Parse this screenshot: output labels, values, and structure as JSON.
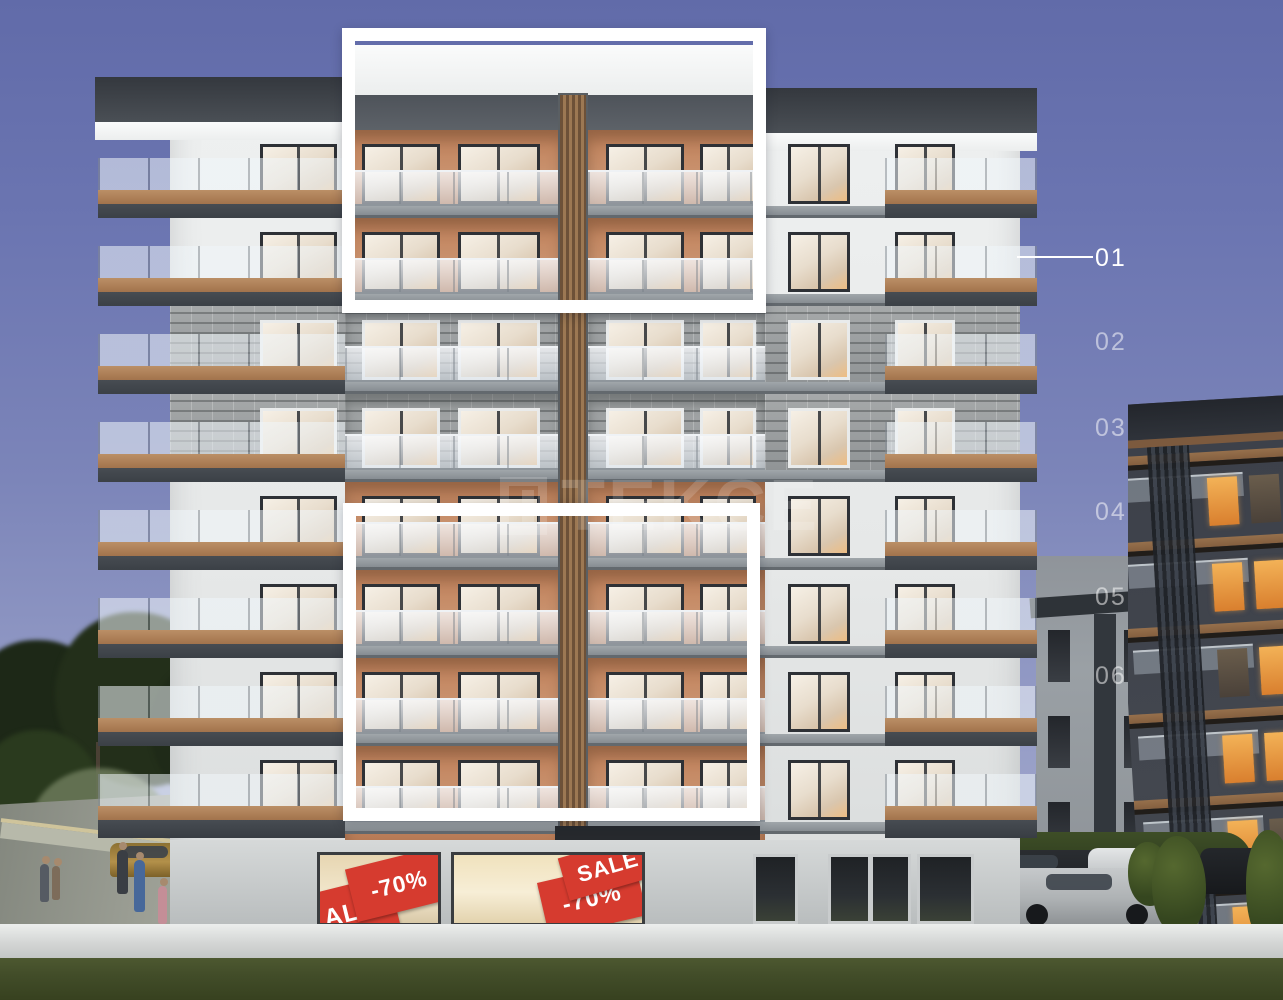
{
  "overlay": {
    "watermark": {
      "text": "TEKCE"
    },
    "floor_labels": [
      {
        "text": "01",
        "state": "active"
      },
      {
        "text": "02",
        "state": "normal"
      },
      {
        "text": "03",
        "state": "normal"
      },
      {
        "text": "04",
        "state": "normal"
      },
      {
        "text": "05",
        "state": "normal"
      },
      {
        "text": "06",
        "state": "normal"
      }
    ]
  },
  "ground_floor": {
    "shop_left": {
      "sign_sale": "ALE",
      "sign_discount": "-70%"
    },
    "shop_right": {
      "sign_discount": "-70%",
      "sign_sale": "SALE"
    }
  },
  "colors": {
    "sky_top": "#6b75b1",
    "sky_bottom": "#9aa1c9",
    "highlight_frame": "#ffffff",
    "floor_label": "#ffffff",
    "sale_red": "#d63b2f",
    "terracotta_wall": "#c8906c",
    "brick_gray": "#9b9fa1",
    "wood_trim": "#b28761",
    "window_glow": "#edbd83",
    "grass": "#424d29",
    "wall_white": "#e9ebeb"
  }
}
